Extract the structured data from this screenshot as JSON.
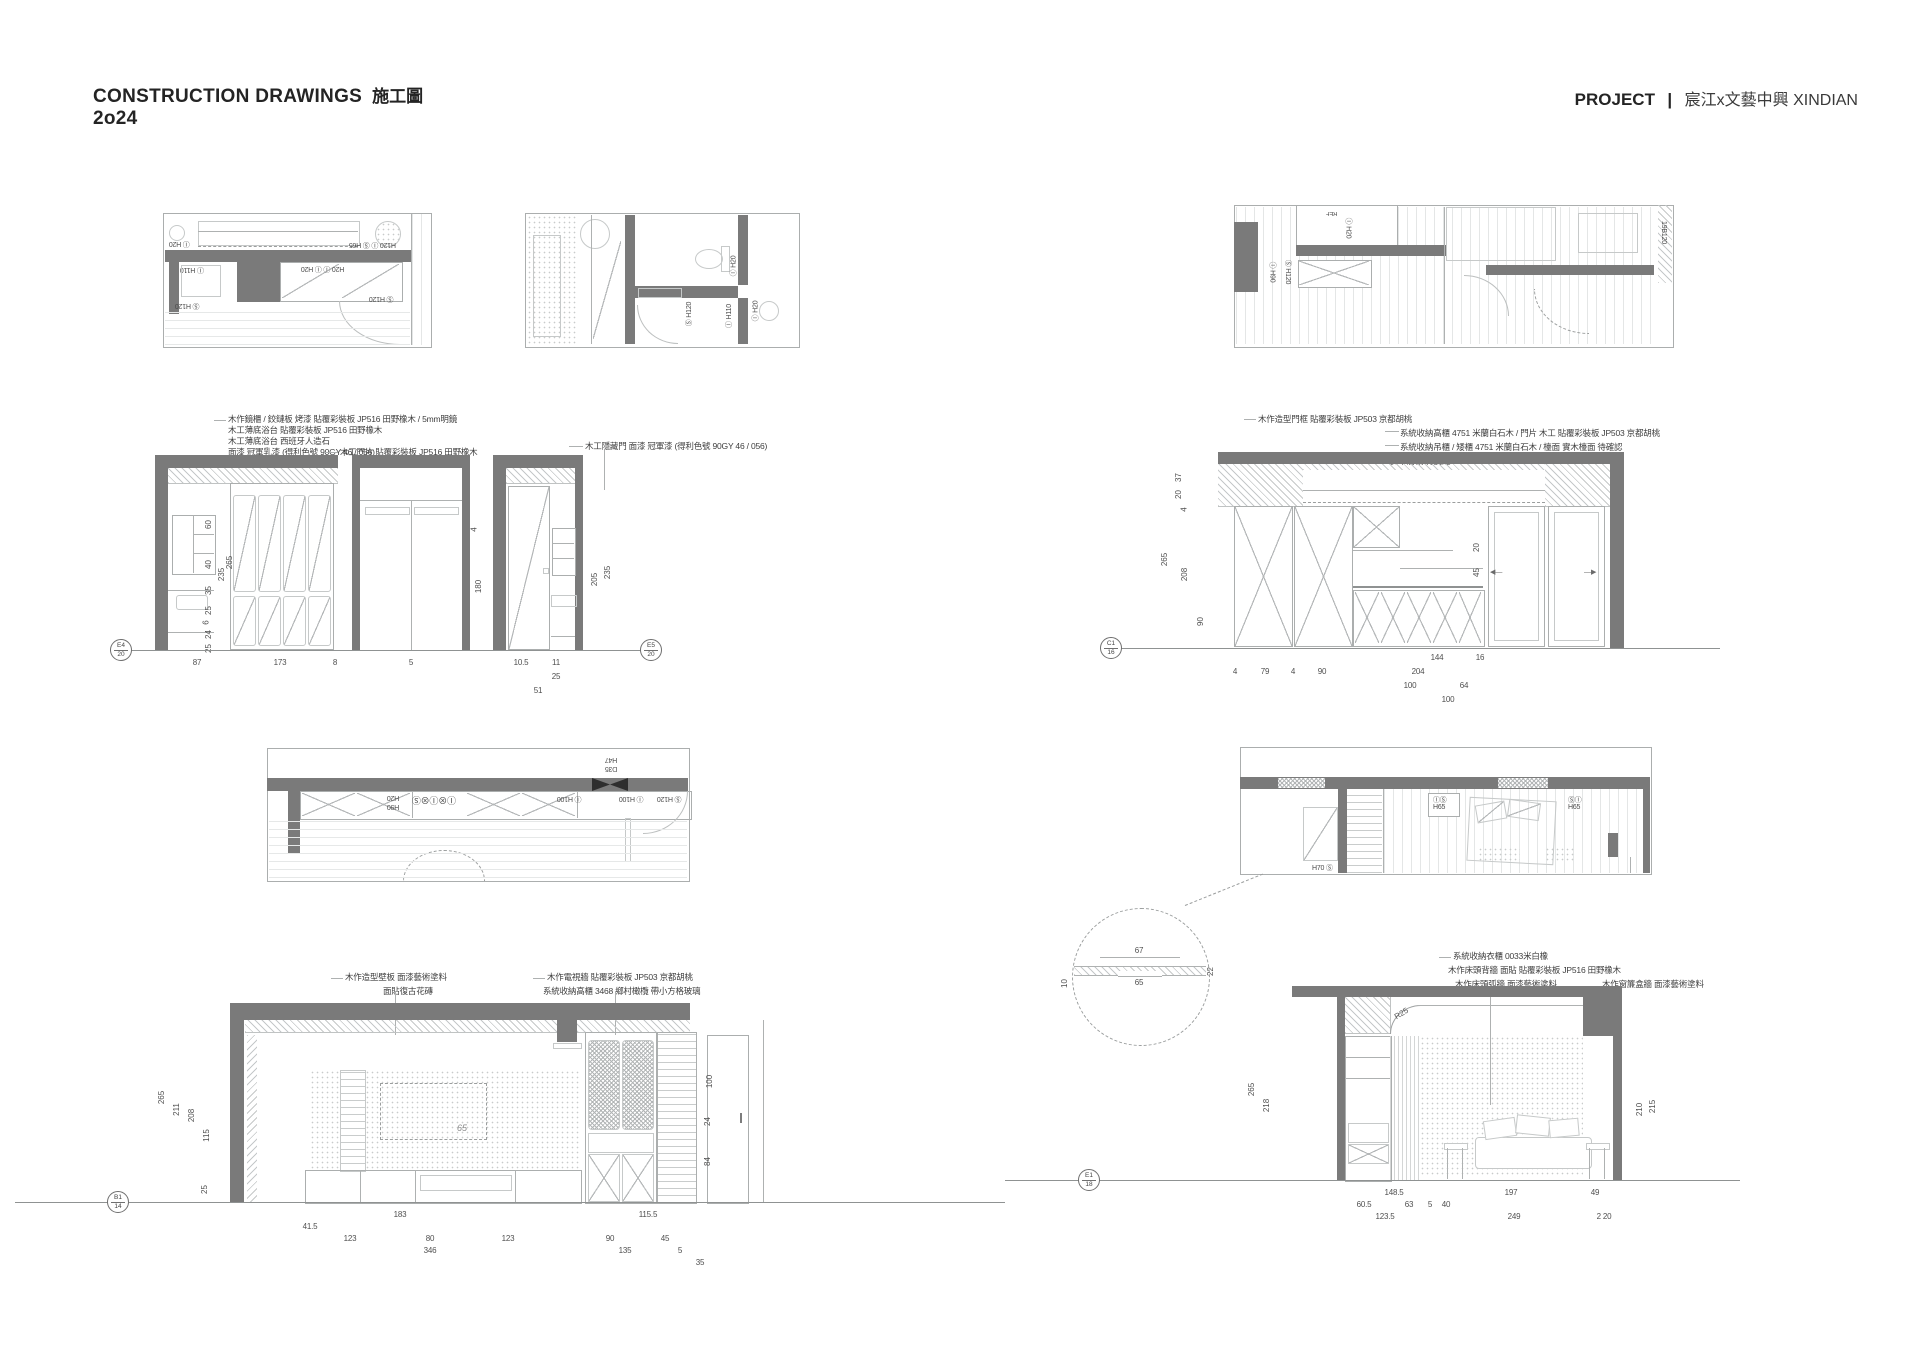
{
  "header": {
    "title_en": "CONSTRUCTION DRAWINGS",
    "title_zh": "施工圖",
    "year": "2o24",
    "project_label": "PROJECT",
    "separator": "|",
    "project_name": "宸江x文藝中興 XINDIAN"
  },
  "colors": {
    "wall": "#7a7a7a",
    "line": "#abaeae",
    "text": "#3c3c3c",
    "paper": "#ffffff"
  },
  "plans": {
    "living": {
      "lamp": "Ⓘ H20",
      "top_right": "H120 Ⓘ Ⓢ H65",
      "cab": "Ⓘ H110",
      "wardrobe": "H20 Ⓘ Ⓘ H20",
      "door": "Ⓢ H120",
      "left": "Ⓢ H120"
    },
    "bath": {
      "l1": "Ⓘ H20",
      "l2": "Ⓢ H120",
      "l3": "Ⓘ H110",
      "l4": "Ⓘ H20"
    },
    "upper": {
      "ref_label": "REF",
      "l1": "Ⓘ H20",
      "l2": "Ⓘ H90",
      "l3": "Ⓢ H120",
      "l4": "19B120"
    },
    "kitchen": {
      "t1": "H47",
      "t2": "D35",
      "l1": "H20",
      "l2": "H90",
      "l3": "Ⓘ⊗Ⓘ⊗Ⓢ",
      "l4": "Ⓘ H100",
      "l5": "Ⓘ H100",
      "l6": "Ⓢ H120"
    },
    "bedroom": {
      "b1a": "ⒾⓈ",
      "b1b": "H65",
      "b2a": "ⓈⒾ",
      "b2b": "H65",
      "l3": "H70 Ⓢ"
    }
  },
  "elev_vanity": {
    "annotations": [
      "木作鏡櫃 / 鉸鏈板 烤漆 貼覆彩裝板 JP516 田野橡木 / 5mm明鏡",
      "木工薄底浴台 貼覆彩裝板 JP516 田野橡木",
      "木工薄底浴台 西班牙人造石",
      "面漆 冠軍乳漆 (得利色號 90GY 46 / 056)",
      "木工門片 貼覆彩裝板 JP516 田野橡木",
      "木工隱藏門 面漆 冠軍漆 (得利色號 90GY 46 / 056)"
    ],
    "dims_inner": [
      "60",
      "40",
      "35",
      "25",
      "6",
      "24",
      "25"
    ],
    "dims_overall": [
      "235",
      "265"
    ],
    "dims_b": [
      "4",
      "180"
    ],
    "dims_c": [
      "205",
      "235"
    ],
    "dims_bottom": [
      "87",
      "173",
      "8",
      "5",
      "10.5",
      "11",
      "25",
      "51"
    ],
    "ref_left_top": "E4",
    "ref_left_bot": "20",
    "ref_right_top": "E5",
    "ref_right_bot": "20"
  },
  "elev_kitchen": {
    "annotations": [
      "木作造型門框 貼覆彩裝板 JP503 京都胡桃",
      "系統收納高櫃 4751 米蘭白石木 / 門片 木工 貼覆彩裝板 JP503 京都胡桃",
      "系統收納吊櫃 / 矮櫃 4751 米蘭白石木 / 檯面 實木檯面 待確認",
      "實木層板 待挑選"
    ],
    "dims_left": [
      "37",
      "20",
      "4",
      "265",
      "208",
      "90"
    ],
    "dims_right": [
      "20",
      "45"
    ],
    "dims_row1": [
      "144",
      "16"
    ],
    "dims_row2": [
      "4",
      "79",
      "4",
      "90",
      "204"
    ],
    "dims_row3": [
      "100",
      "64"
    ],
    "dims_row4": [
      "100"
    ],
    "ref_top": "C1",
    "ref_bot": "16"
  },
  "elev_tv": {
    "annotations": [
      "木作造型壁板 面漆藝術塗料",
      "面貼復古花磚",
      "木作電視牆 貼覆彩裝板 JP503 京都胡桃",
      "系統收納高櫃 3468 鄉村橄欖 帶小方格玻璃"
    ],
    "tv_label": "65",
    "dims_left": [
      "265",
      "211",
      "208",
      "115",
      "25"
    ],
    "dims_right": [
      "100",
      "24",
      "84"
    ],
    "dims_row1": [
      "183",
      "115.5"
    ],
    "dims_row2": [
      "41.5"
    ],
    "dims_row3": [
      "123",
      "80",
      "123",
      "90",
      "45"
    ],
    "dims_row4": [
      "346",
      "135",
      "5"
    ],
    "dims_row5": [
      "35"
    ],
    "ref_top": "B1",
    "ref_bot": "14"
  },
  "elev_bedroom": {
    "annotations": [
      "系統收納衣櫃 0033米白橡",
      "木作床頭背牆 面貼 貼覆彩裝板 JP516 田野橡木",
      "木作床頭弧牆 面漆藝術塗料",
      "木作窗簾盒牆 面漆藝術塗料"
    ],
    "radius_label": "R25",
    "dims_left": [
      "265",
      "218"
    ],
    "dims_right": [
      "210",
      "215"
    ],
    "dims_row1": [
      "148.5",
      "197",
      "49"
    ],
    "dims_row2": [
      "60.5",
      "63",
      "5",
      "40"
    ],
    "dims_row3": [
      "123.5",
      "249",
      "2 20"
    ],
    "ref_top": "E1",
    "ref_bot": "18"
  },
  "detail": {
    "top": "67",
    "bottom": "65",
    "right": "22",
    "left": "10"
  }
}
